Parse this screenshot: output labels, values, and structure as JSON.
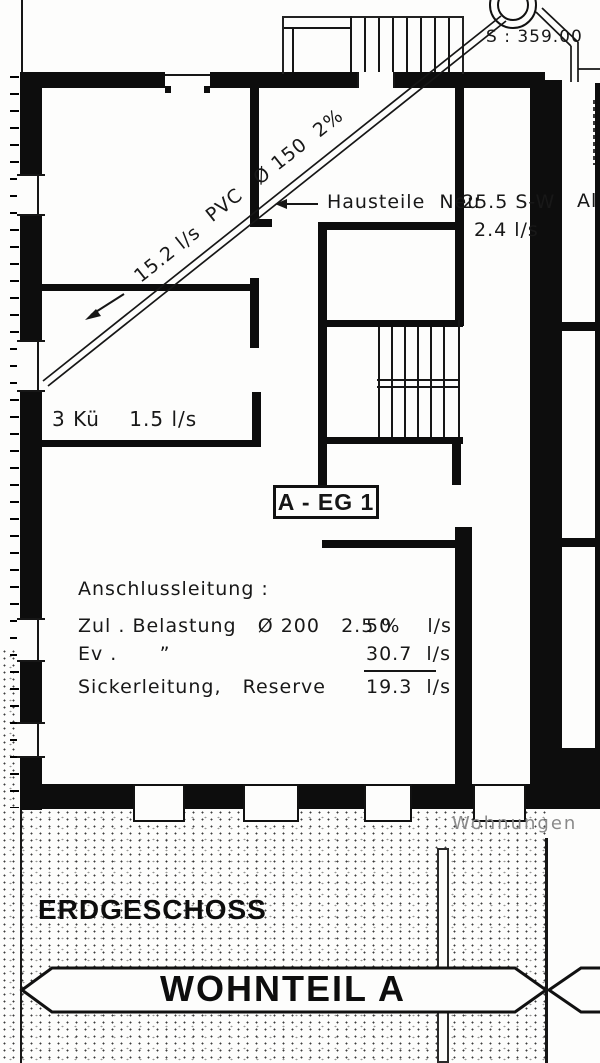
{
  "plan": {
    "shaft_elevation": "S : 359.00",
    "pipe": {
      "flow": "15.2 l/s",
      "material": "PVC",
      "diameter": "Ø 150",
      "slope": "2%"
    },
    "annotations": {
      "hausteile": "Hausteile  Neu",
      "sw_area": "25.5 S-W",
      "sw_flow": "2.4 l/s",
      "clipped_right": "Al",
      "kitchen": "3 Kü    1.5 l/s",
      "room_tag": "A - EG 1",
      "wohnungen": "Wohnungen"
    },
    "connection_table": {
      "heading": "Anschlussleitung :",
      "rows": [
        {
          "label": "Zul . Belastung   Ø 200   2.5 %",
          "value": "50     l/s"
        },
        {
          "label": "Ev .      ”",
          "value": "30.7  l/s"
        },
        {
          "label": "Sickerleitung,   Reserve",
          "value": "19.3  l/s"
        }
      ]
    }
  },
  "footer": {
    "floor_label": "ERDGESCHOSS",
    "banner_label": "WOHNTEIL A"
  }
}
